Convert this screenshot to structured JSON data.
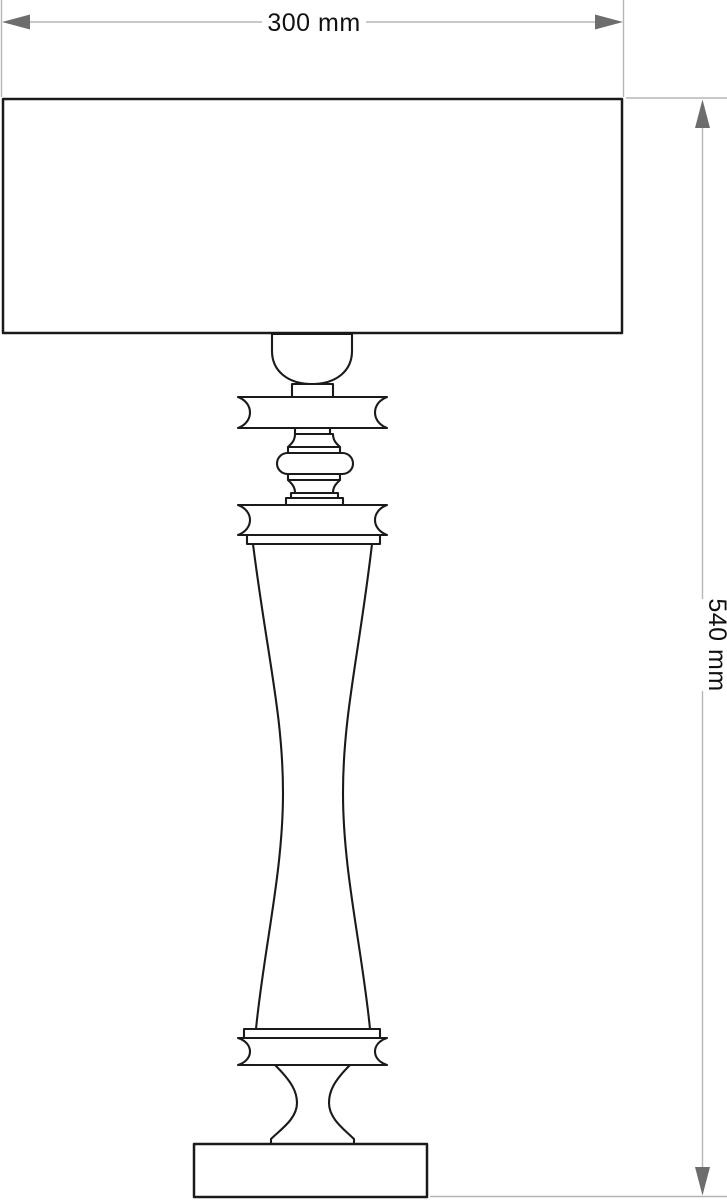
{
  "drawing": {
    "type": "lamp-elevation-technical-drawing",
    "dimensions": {
      "width_label": "300 mm",
      "height_label": "540 mm"
    },
    "colors": {
      "outline": "#1a1a1a",
      "dimension_line": "#b5b5b5",
      "arrowhead": "#6d6d6d",
      "label_text": "#111111",
      "background": "#ffffff"
    }
  }
}
